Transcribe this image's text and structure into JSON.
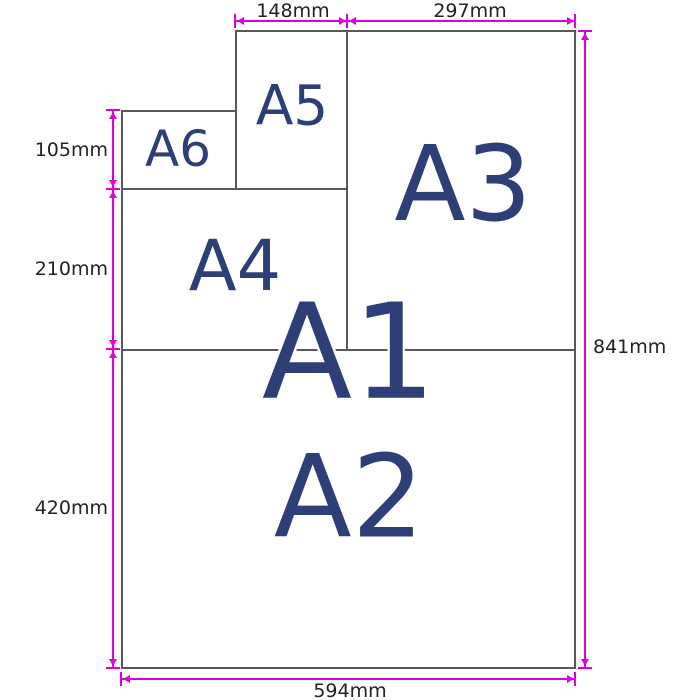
{
  "diagram": {
    "type": "paper-size-diagram",
    "sheets": [
      {
        "id": "A1",
        "label": "A1"
      },
      {
        "id": "A2",
        "label": "A2"
      },
      {
        "id": "A3",
        "label": "A3"
      },
      {
        "id": "A4",
        "label": "A4"
      },
      {
        "id": "A5",
        "label": "A5"
      },
      {
        "id": "A6",
        "label": "A6"
      }
    ],
    "dimensions": {
      "a5_width": "148mm",
      "a3_width": "297mm",
      "a6_height": "105mm",
      "a4_height": "210mm",
      "a2_height": "420mm",
      "total_height": "841mm",
      "total_width": "594mm"
    },
    "colors": {
      "dimension_line": "#dd00dd",
      "sheet_border": "#58585a",
      "sheet_label": "#2e3f77",
      "dimension_text": "#222222"
    }
  }
}
